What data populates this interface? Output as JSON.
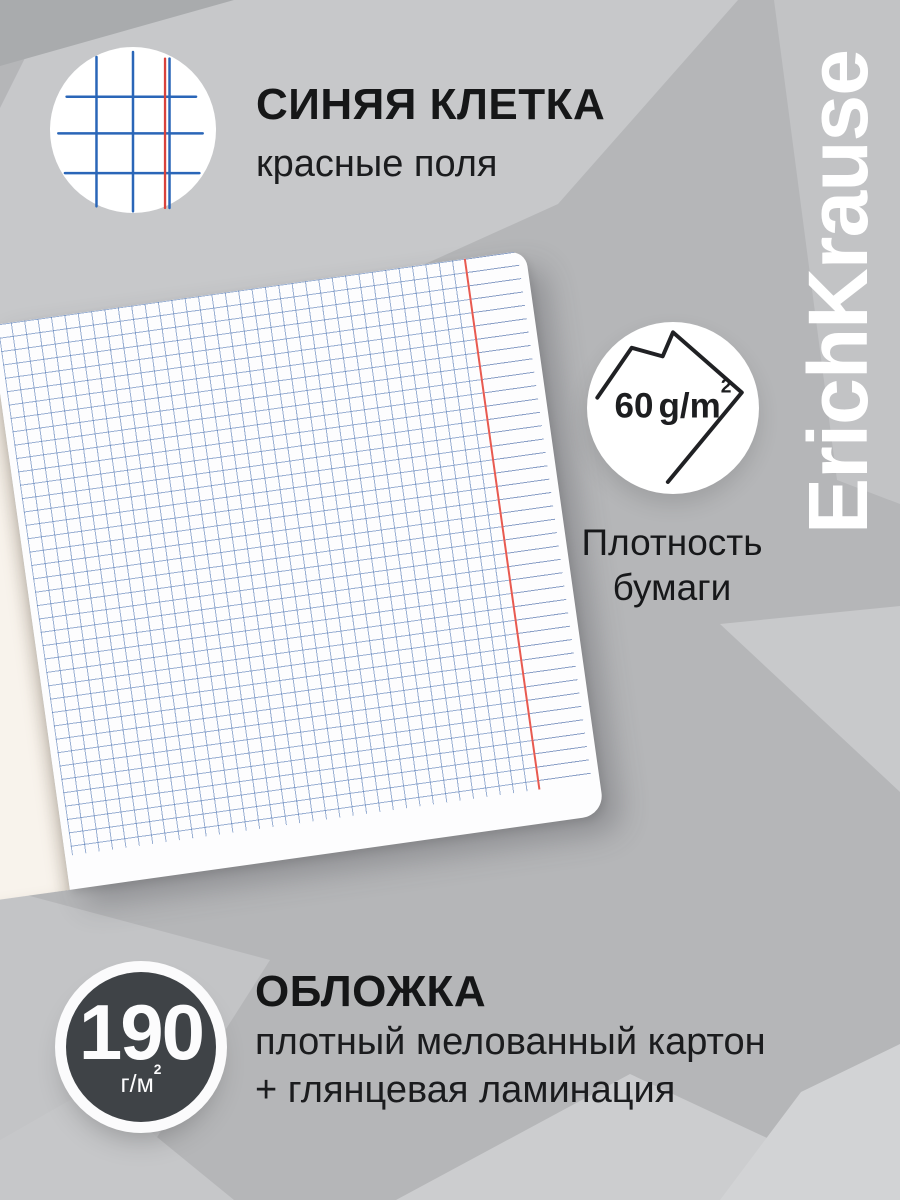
{
  "brand": {
    "logo_text": "ErichKrause"
  },
  "feature_grid": {
    "icon": "squared-grid-icon",
    "title": "СИНЯЯ КЛЕТКА",
    "subtitle": "красные поля"
  },
  "density": {
    "icon": "paper-sheet-icon",
    "value": "60",
    "unit_main": "g/m",
    "unit_sup": "2",
    "label_line1": "Плотность",
    "label_line2": "бумаги"
  },
  "cover": {
    "value": "190",
    "unit_main": "г/м",
    "unit_sup": "2",
    "title": "ОБЛОЖКА",
    "desc_line1": "плотный мелованный картон",
    "desc_line2": "+ глянцевая ламинация"
  },
  "colors": {
    "background_base": "#b5b6b8",
    "grid_blue": "#4d76b2",
    "margin_red": "#e85a50",
    "badge_dark": "#3f4347",
    "page_cream": "#f8f3ec",
    "text_dark": "#1b1c1e",
    "brand_white": "#ffffff"
  }
}
